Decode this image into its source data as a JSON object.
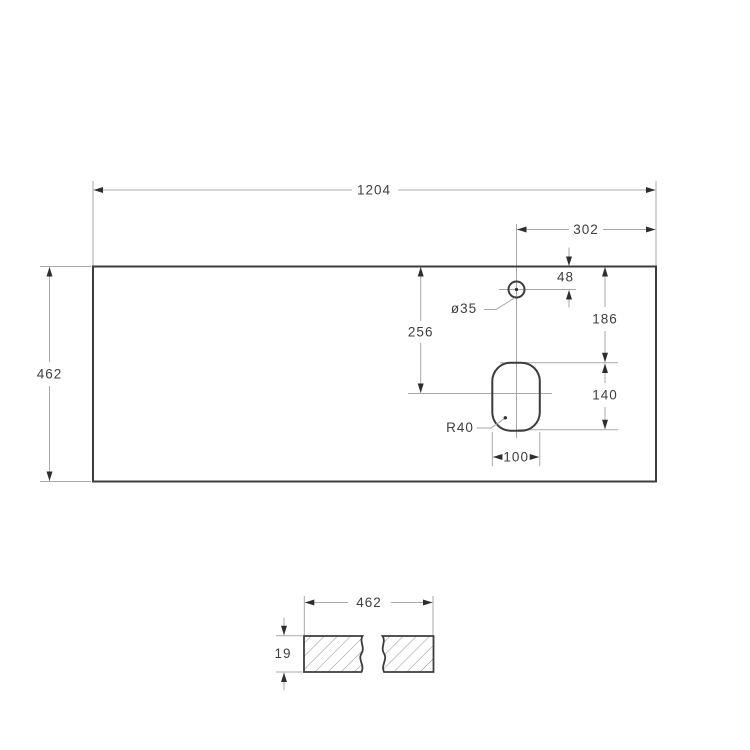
{
  "top_view": {
    "overall_width": "1204",
    "overall_depth": "462",
    "faucet_offset_from_right": "302",
    "faucet_offset_from_edge": "48",
    "faucet_hole_diameter": "ø35",
    "drain_center_depth": "256",
    "edge_to_drain": "186",
    "drain_length": "140",
    "drain_width": "100",
    "drain_corner_radius": "R40"
  },
  "section_view": {
    "depth": "462",
    "thickness": "19"
  },
  "colors": {
    "outline": "#3c3c3c",
    "dimension_lines": "#a8a8a8",
    "arrowheads": "#2e2e2e",
    "text": "#3e3e3e",
    "background": "#ffffff"
  }
}
